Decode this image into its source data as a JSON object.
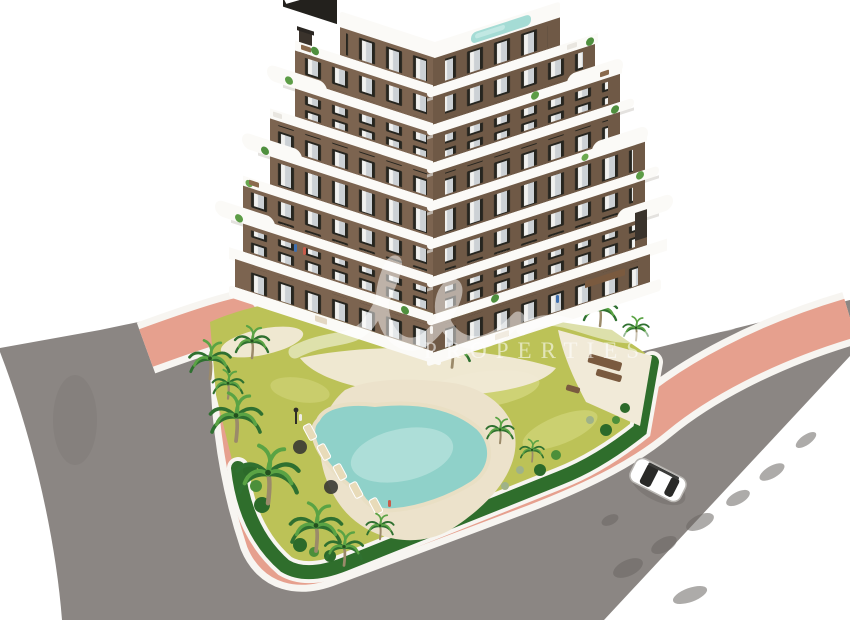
{
  "meta": {
    "title": "Aerial 3D architectural render — new-build apartment block with pool garden",
    "scene_type": "architectural visualization on white cut-out background"
  },
  "watermark": {
    "script_hint": "translucent cursive agency logo",
    "caption": "PROPERTIES"
  },
  "objects": {
    "building": {
      "floors_visible": 7,
      "style": "brown facade with curved white balcony bands",
      "rooftop_pool": "yes"
    },
    "garden_pool": {
      "shape": "freeform",
      "loungers": 5,
      "parasols": 2
    },
    "palm_trees": 14,
    "car": {
      "color": "white",
      "location": "right road"
    },
    "sidewalk": {
      "color_name": "pink"
    },
    "roads": {
      "surface": "gray asphalt",
      "tree_shadows": "along right edge"
    }
  },
  "palette": {
    "background": "#ffffff",
    "road": "#8b8683",
    "road_shadow": "#6b6763",
    "sidewalk": "#e6a08e",
    "curb": "#f7f5f1",
    "lawn": "#bcc257",
    "lawn_light": "#d6d881",
    "hedge": "#2f6e2c",
    "palm_dark": "#2f7030",
    "palm_light": "#5aa344",
    "trunk": "#9b8a6a",
    "pool_water": "#8fd1c9",
    "pool_water_light": "#c6e9e3",
    "pool_deck": "#ece2cb",
    "gravel": "#f1ead8",
    "facade_left": "#7c6450",
    "facade_right": "#6f5946",
    "window_frame": "#26251f",
    "window_glass": "#ccd1d5",
    "slab_white": "#fbfaf7",
    "slab_shadow": "#d9d6d1",
    "roof_pool": "#a5dcd5",
    "chimney": "#3a332c",
    "furniture_brown": "#7a5a3f",
    "car_body": "#ffffff",
    "car_glass": "#2a2a28"
  }
}
